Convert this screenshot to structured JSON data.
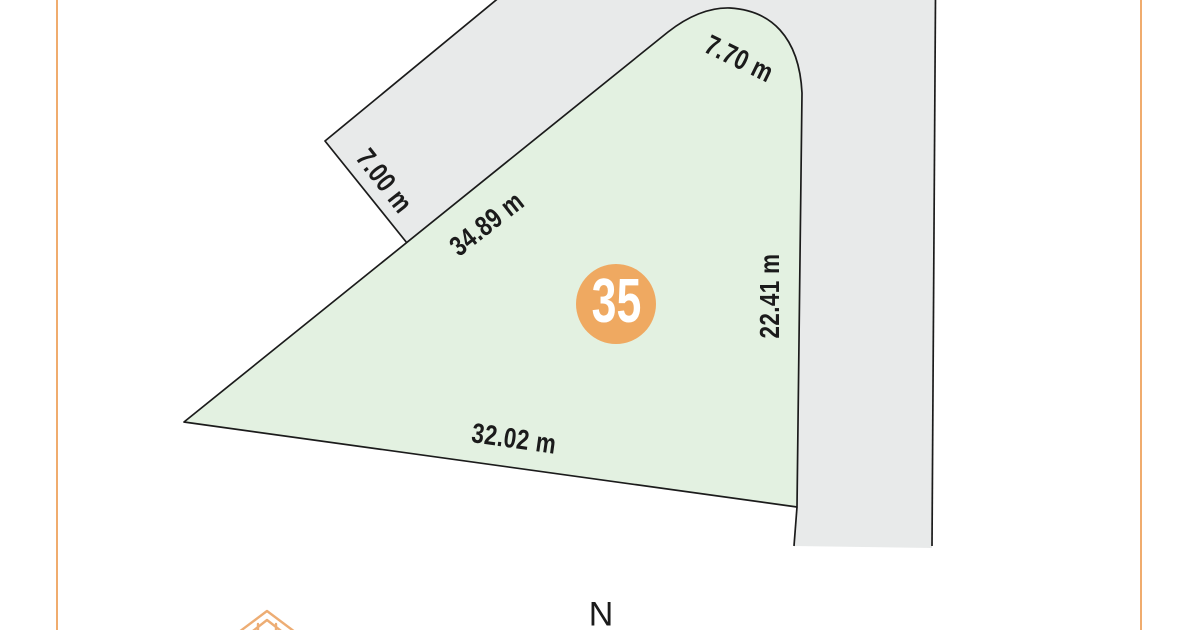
{
  "colors": {
    "background": "#FFFFFF",
    "lot_fill": "#E3F1E1",
    "road_fill": "#E8EAEA",
    "outline": "#1B1B1B",
    "accent_orange": "#EFA961",
    "frame_orange": "#F0AC6E",
    "house_icon_orange": "#EDAD74",
    "label_text": "#1B1B1B",
    "lot_number_text": "#FFFFFF"
  },
  "lot": {
    "number": "35",
    "dimensions": {
      "upper_left_edge": "34.89 m",
      "top_edge": "7.70 m",
      "right_edge": "22.41 m",
      "bottom_edge": "32.02 m",
      "road_width": "7.00 m"
    }
  },
  "compass": {
    "north": "N"
  },
  "icons": {
    "house": "house-icon"
  }
}
